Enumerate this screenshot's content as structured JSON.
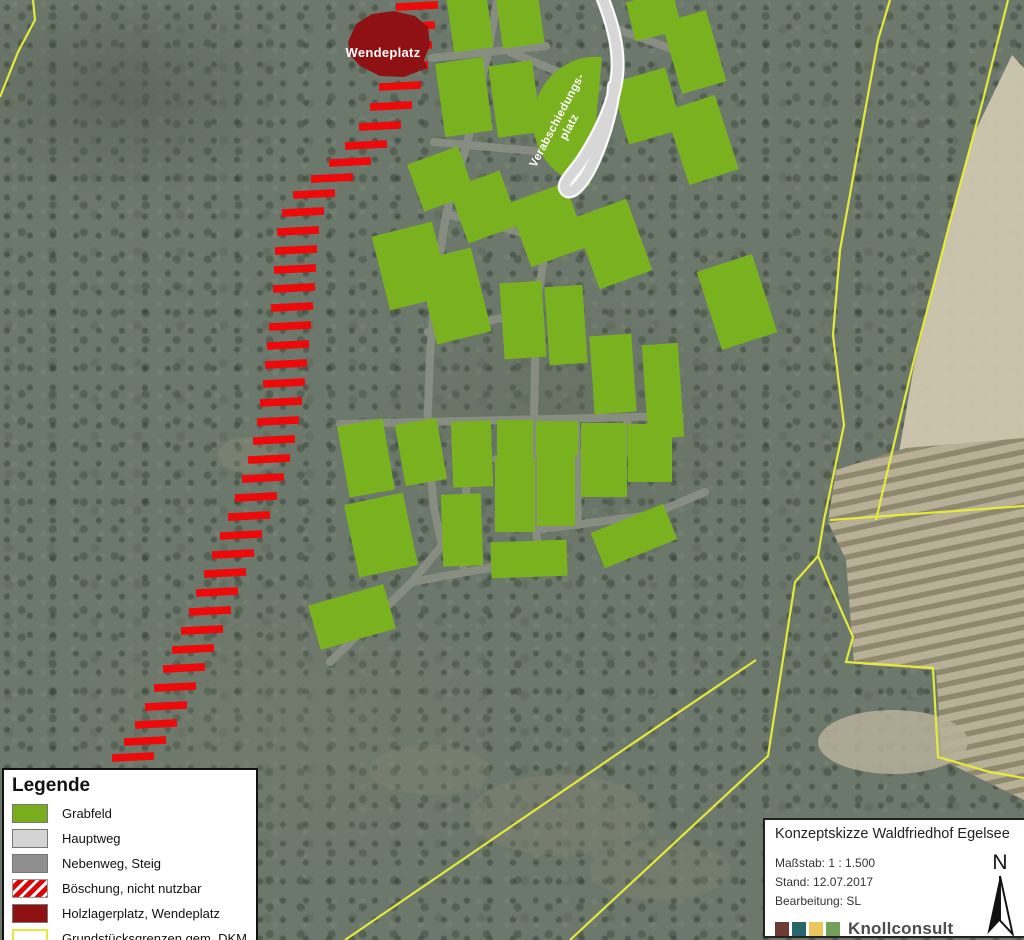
{
  "labels": {
    "wendeplatz": "Wendeplatz",
    "verabschiedungsplatz_line1": "Verabschiedungs-",
    "verabschiedungsplatz_line2": "platz"
  },
  "legend": {
    "title": "Legende",
    "items": [
      {
        "swatch": "grabfeld-swatch",
        "label": "Grabfeld"
      },
      {
        "swatch": "hauptweg-swatch",
        "label": "Hauptweg"
      },
      {
        "swatch": "nebenweg-swatch",
        "label": "Nebenweg, Steig"
      },
      {
        "swatch": "boeschung-swatch",
        "label": "Böschung, nicht nutzbar"
      },
      {
        "swatch": "holzlagerplatz-swatch",
        "label": "Holzlagerplatz, Wendeplatz"
      },
      {
        "swatch": "grundstuecksgrenzen-swatch",
        "label": "Grundstücksgrenzen gem. DKM"
      }
    ]
  },
  "title_block": {
    "title": "Konzeptskizze Waldfriedhof Egelsee",
    "scale_label": "Maßstab: 1 : 1.500",
    "date_label": "Stand: 12.07.2017",
    "editor_label": "Bearbeitung: SL",
    "company": "Knollconsult",
    "company_sub": "Unternehmensgruppe",
    "north_label": "N",
    "logo_colors": [
      "#6d3b33",
      "#27666a",
      "#e9c75e",
      "#71a05a"
    ]
  },
  "colors": {
    "grabfeld": "#7ab21f",
    "hauptweg_fill": "#d7d7d7",
    "hauptweg_casing": "#fafafa",
    "nebenweg": "#8a8f84",
    "boeschung": "#ee0a0a",
    "holzlager": "#8f1113",
    "boundary": "#e9ef3a",
    "field": "#cdc7ae",
    "vineyard": "#b7b096"
  },
  "map_features": {
    "field": [
      [
        1012,
        55
      ],
      [
        1024,
        68
      ],
      [
        1024,
        470
      ],
      [
        898,
        458
      ],
      [
        914,
        366
      ],
      [
        940,
        260
      ],
      [
        972,
        138
      ]
    ],
    "vineyard": [
      [
        836,
        470
      ],
      [
        906,
        448
      ],
      [
        1024,
        438
      ],
      [
        1024,
        800
      ],
      [
        942,
        760
      ],
      [
        936,
        670
      ],
      [
        854,
        664
      ],
      [
        846,
        560
      ],
      [
        828,
        522
      ]
    ],
    "patches": [
      {
        "cx": 893,
        "cy": 742,
        "rx": 75,
        "ry": 32,
        "fill": "#b6b09a",
        "op": 0.85
      },
      {
        "cx": 955,
        "cy": 905,
        "rx": 60,
        "ry": 30,
        "fill": "#b0a990",
        "op": 0.6
      },
      {
        "cx": 560,
        "cy": 815,
        "rx": 90,
        "ry": 40,
        "fill": "#8c8c73",
        "op": 0.3
      },
      {
        "cx": 430,
        "cy": 770,
        "rx": 60,
        "ry": 25,
        "fill": "#8c8c73",
        "op": 0.25
      },
      {
        "cx": 660,
        "cy": 870,
        "rx": 70,
        "ry": 30,
        "fill": "#87876e",
        "op": 0.25
      },
      {
        "cx": 248,
        "cy": 455,
        "rx": 30,
        "ry": 18,
        "fill": "#969678",
        "op": 0.3
      }
    ],
    "boundaries": [
      [
        [
          33,
          0
        ],
        [
          35,
          20
        ],
        [
          18,
          52
        ],
        [
          0,
          97
        ]
      ],
      [
        [
          890,
          0
        ],
        [
          878,
          40
        ],
        [
          858,
          150
        ],
        [
          840,
          250
        ],
        [
          833,
          335
        ],
        [
          844,
          425
        ],
        [
          824,
          520
        ],
        [
          818,
          556
        ],
        [
          795,
          582
        ],
        [
          768,
          756
        ],
        [
          570,
          940
        ]
      ],
      [
        [
          1008,
          0
        ],
        [
          983,
          100
        ],
        [
          950,
          222
        ],
        [
          935,
          280
        ],
        [
          912,
          368
        ],
        [
          893,
          448
        ],
        [
          876,
          520
        ]
      ],
      [
        [
          830,
          520
        ],
        [
          1024,
          506
        ]
      ],
      [
        [
          818,
          556
        ],
        [
          830,
          585
        ],
        [
          853,
          637
        ],
        [
          846,
          662
        ],
        [
          933,
          668
        ],
        [
          938,
          757
        ],
        [
          990,
          772
        ],
        [
          1024,
          778
        ]
      ],
      [
        [
          345,
          940
        ],
        [
          623,
          750
        ],
        [
          756,
          660
        ]
      ]
    ],
    "neben": [
      [
        [
          497,
          2
        ],
        [
          486,
          62
        ],
        [
          466,
          148
        ],
        [
          446,
          215
        ],
        [
          436,
          278
        ],
        [
          430,
          355
        ],
        [
          427,
          435
        ],
        [
          434,
          508
        ],
        [
          442,
          545
        ],
        [
          412,
          582
        ],
        [
          330,
          662
        ]
      ],
      [
        [
          432,
          58
        ],
        [
          546,
          46
        ]
      ],
      [
        [
          510,
          52
        ],
        [
          598,
          88
        ]
      ],
      [
        [
          434,
          142
        ],
        [
          568,
          154
        ]
      ],
      [
        [
          614,
          28
        ],
        [
          702,
          60
        ]
      ],
      [
        [
          570,
          188
        ],
        [
          546,
          244
        ],
        [
          536,
          310
        ],
        [
          534,
          420
        ],
        [
          536,
          528
        ],
        [
          540,
          572
        ]
      ],
      [
        [
          446,
          214
        ],
        [
          505,
          228
        ],
        [
          545,
          240
        ]
      ],
      [
        [
          428,
          332
        ],
        [
          502,
          318
        ],
        [
          536,
          312
        ]
      ],
      [
        [
          496,
          459
        ],
        [
          668,
          450
        ]
      ],
      [
        [
          576,
          420
        ],
        [
          578,
          525
        ]
      ],
      [
        [
          627,
          418
        ],
        [
          630,
          452
        ]
      ],
      [
        [
          536,
          530
        ],
        [
          650,
          515
        ],
        [
          705,
          492
        ]
      ],
      [
        [
          412,
          582
        ],
        [
          500,
          566
        ],
        [
          540,
          572
        ]
      ],
      [
        [
          469,
          422
        ],
        [
          463,
          566
        ]
      ],
      [
        [
          340,
          424
        ],
        [
          680,
          416
        ]
      ]
    ],
    "parcels": [
      [
        470,
        22,
        40,
        56,
        -8
      ],
      [
        520,
        19,
        42,
        54,
        -8
      ],
      [
        654,
        16,
        48,
        40,
        -14
      ],
      [
        694,
        52,
        46,
        74,
        -16
      ],
      [
        464,
        97,
        48,
        74,
        -8
      ],
      [
        515,
        99,
        44,
        72,
        -8
      ],
      [
        647,
        106,
        56,
        64,
        -16
      ],
      [
        702,
        140,
        52,
        78,
        -18
      ],
      [
        441,
        179,
        54,
        50,
        -20
      ],
      [
        484,
        207,
        54,
        58,
        -20
      ],
      [
        548,
        225,
        60,
        68,
        -20
      ],
      [
        613,
        244,
        56,
        76,
        -20
      ],
      [
        737,
        302,
        58,
        82,
        -18
      ],
      [
        411,
        266,
        62,
        76,
        -14
      ],
      [
        454,
        296,
        56,
        86,
        -14
      ],
      [
        523,
        320,
        42,
        76,
        -4
      ],
      [
        566,
        325,
        38,
        78,
        -4
      ],
      [
        613,
        374,
        42,
        78,
        -4
      ],
      [
        663,
        391,
        36,
        94,
        -4
      ],
      [
        366,
        458,
        46,
        72,
        -10
      ],
      [
        421,
        452,
        42,
        62,
        -10
      ],
      [
        472,
        454,
        40,
        66,
        -2
      ],
      [
        515,
        439,
        36,
        38,
        0
      ],
      [
        557,
        438,
        42,
        34,
        0
      ],
      [
        604,
        460,
        46,
        74,
        0
      ],
      [
        650,
        453,
        44,
        58,
        0
      ],
      [
        515,
        495,
        40,
        74,
        0
      ],
      [
        556,
        490,
        38,
        72,
        0
      ],
      [
        462,
        530,
        40,
        72,
        -2
      ],
      [
        529,
        559,
        76,
        36,
        -2
      ],
      [
        381,
        535,
        60,
        74,
        -12
      ],
      [
        634,
        536,
        78,
        38,
        -22
      ],
      [
        352,
        617,
        78,
        46,
        -16
      ]
    ],
    "verab_disc": "M 602,57 A 62 64 0 0 0 590,186 Z",
    "hauptweg": "M 601,-6 C 612,22 620,48 617,76 C 614,104 599,134 583,159 C 571,176 561,184 566,190 C 572,196 584,182 594,160 C 605,135 613,106 614,86",
    "hatch_bars": [
      [
        417,
        6
      ],
      [
        414,
        26
      ],
      [
        411,
        46
      ],
      [
        407,
        66
      ],
      [
        400,
        86
      ],
      [
        391,
        106
      ],
      [
        380,
        126
      ],
      [
        366,
        145
      ],
      [
        350,
        162
      ],
      [
        332,
        178
      ],
      [
        314,
        194
      ],
      [
        303,
        212
      ],
      [
        298,
        231
      ],
      [
        296,
        250
      ],
      [
        295,
        269
      ],
      [
        294,
        288
      ],
      [
        292,
        307
      ],
      [
        290,
        326
      ],
      [
        288,
        345
      ],
      [
        286,
        364
      ],
      [
        284,
        383
      ],
      [
        281,
        402
      ],
      [
        278,
        421
      ],
      [
        274,
        440
      ],
      [
        269,
        459
      ],
      [
        263,
        478
      ],
      [
        256,
        497
      ],
      [
        249,
        516
      ],
      [
        241,
        535
      ],
      [
        233,
        554
      ],
      [
        225,
        573
      ],
      [
        217,
        592
      ],
      [
        210,
        611
      ],
      [
        202,
        630
      ],
      [
        193,
        649
      ],
      [
        184,
        668
      ],
      [
        175,
        687
      ],
      [
        166,
        706
      ],
      [
        156,
        724
      ],
      [
        145,
        741
      ],
      [
        133,
        757
      ]
    ],
    "wendeplatz_blob": "348,42 356,24 372,14 394,11 415,16 428,27 430,45 424,60 427,68 404,77 380,76 360,66 350,55",
    "wendeplatz_label": [
      383,
      57
    ],
    "verab_label": [
      560,
      122
    ]
  }
}
